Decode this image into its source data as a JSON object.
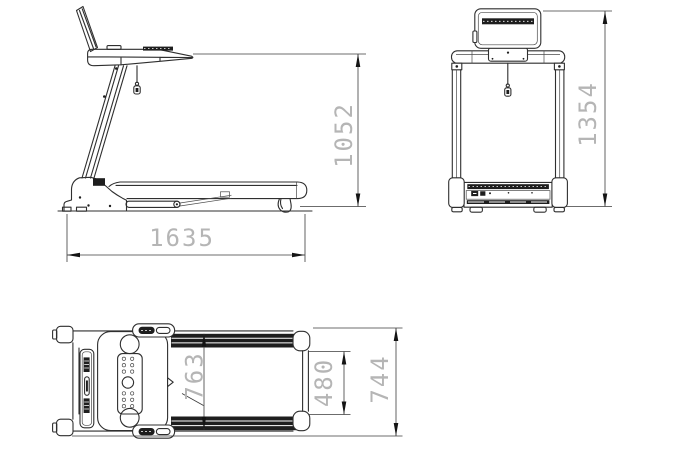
{
  "drawing": {
    "background": "#ffffff",
    "line_color": "#2f2f2f",
    "dimension_line_color": "#3c3c3c",
    "dimension_text_color": "#b5b5b5",
    "arrow_color": "#141414"
  },
  "dimensions": {
    "side_view": {
      "length_mm": "1635",
      "height_mm": "1052"
    },
    "front_view": {
      "height_mm": "1354"
    },
    "top_view": {
      "deck_width_mm": "763",
      "belt_width_mm": "480",
      "overall_width_mm": "744"
    }
  }
}
